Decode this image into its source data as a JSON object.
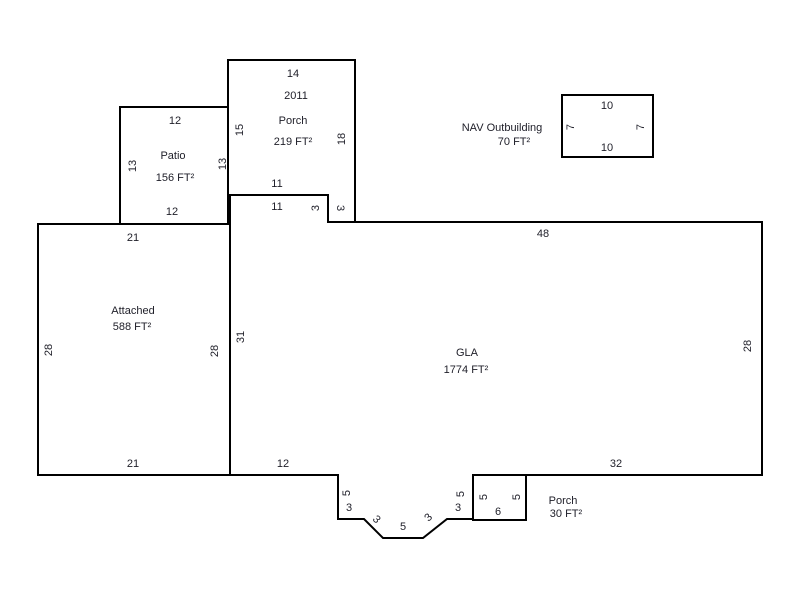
{
  "regions": {
    "porch_top": {
      "label": "Porch",
      "area": "219 FT²",
      "year_built": "2011",
      "dims": {
        "top": "14",
        "left": "15",
        "right": "18",
        "bottom": "11",
        "step_bottom": "3"
      }
    },
    "patio": {
      "label": "Patio",
      "area": "156 FT²",
      "dims": {
        "top": "12",
        "left": "13",
        "right": "13",
        "bottom": "12"
      }
    },
    "outbuilding": {
      "label": "NAV Outbuilding",
      "area": "70 FT²",
      "dims": {
        "top": "10",
        "left": "7",
        "right": "7",
        "bottom": "10"
      }
    },
    "attached": {
      "label": "Attached",
      "area": "588 FT²",
      "dims": {
        "top": "21",
        "left": "28",
        "right": "28",
        "bottom": "21"
      }
    },
    "gla": {
      "label": "GLA",
      "area": "1774 FT²",
      "dims": {
        "top_left": "11",
        "left_step": "3",
        "top": "48",
        "left": "31",
        "right": "28",
        "bottom_left": "12",
        "bottom_right": "32",
        "bay_left_vertical": "5",
        "bay_left_horizontal": "3",
        "bay_left_diagonal": "3",
        "bay_bottom": "5",
        "bay_right_diagonal": "3",
        "bay_right_horizontal": "3",
        "bay_right_vertical": "5"
      }
    },
    "porch_bottom": {
      "label": "Porch",
      "area": "30 FT²",
      "dims": {
        "left": "5",
        "right": "5",
        "bottom": "6"
      }
    }
  },
  "colors": {
    "background": "#ffffff",
    "line": "#000000",
    "text": "#1e1e28"
  }
}
